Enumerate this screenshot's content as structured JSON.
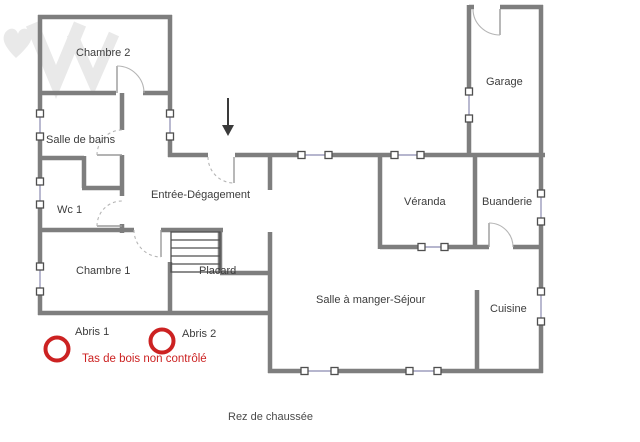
{
  "colors": {
    "wall": "#7e7e7e",
    "text": "#3c3c3c",
    "red": "#cc2222",
    "glass": "#8a8ab0",
    "frame": "#4f4f4f",
    "arc": "#b5b5b5",
    "thin": "#9a9a9a",
    "watermark": "#e9e9e9"
  },
  "plan": {
    "floor_title": "Rez de chaussée",
    "rooms": [
      {
        "id": "chambre-2",
        "label": "Chambre 2"
      },
      {
        "id": "garage",
        "label": "Garage"
      },
      {
        "id": "salle-de-bains",
        "label": "Salle de bains"
      },
      {
        "id": "wc-1",
        "label": "Wc 1"
      },
      {
        "id": "entree-degagement",
        "label": "Entrée-Dégagement"
      },
      {
        "id": "veranda",
        "label": "Véranda"
      },
      {
        "id": "buanderie",
        "label": "Buanderie"
      },
      {
        "id": "chambre-1",
        "label": "Chambre 1"
      },
      {
        "id": "placard",
        "label": "Placard"
      },
      {
        "id": "salle-a-manger-sejour",
        "label": "Salle à manger-Séjour"
      },
      {
        "id": "cuisine",
        "label": "Cuisine"
      }
    ],
    "annotations": {
      "abris_1": "Abris 1",
      "abris_2": "Abris 2",
      "warning": "Tas de bois non contrôlé"
    }
  }
}
